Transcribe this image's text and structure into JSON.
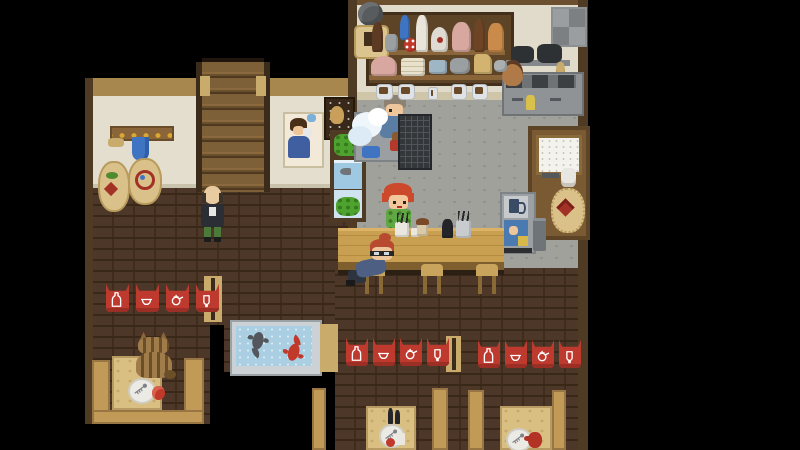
{
  "window": {
    "width": 800,
    "height": 450,
    "background": "#000000"
  },
  "scene": {
    "description": "top-down pixel-art izakaya tavern interior",
    "areas": [
      "kitchen-and-bar",
      "entry-hall-with-stairs",
      "booth-seating",
      "koi-pond-nook"
    ]
  },
  "palette": {
    "wall_cream": "#e3decd",
    "wood_beam": "#a8874e",
    "wood_frame": "#4f3b24",
    "brick_floor": "#4c3729",
    "kitchen_floor": "#a1a19b",
    "counter_top": "#c99f52",
    "bench_tan": "#c29a58",
    "table_tan": "#d9bf82",
    "banner_red": "#bf3a2e",
    "pond_water": "#aacfe2",
    "koi_red": "#c0392a",
    "koi_grey": "#53565c",
    "stairs_wood": "#7d5f38"
  },
  "characters": [
    {
      "id": "dishwasher",
      "desc": "man washing dishes at kitchen sink",
      "hair": "#8d8271",
      "shirt": "#5c7da3"
    },
    {
      "id": "bartender",
      "desc": "red-haired woman behind bar counter",
      "hair": "#cc4a2b",
      "shirt": "#61a844"
    },
    {
      "id": "bald-patron",
      "desc": "bald man in dark jacket near stairs",
      "jacket": "#2b2e34",
      "pants": "#4c7a38"
    },
    {
      "id": "seated-patron",
      "desc": "red-haired customer with glasses on bar stool",
      "hair": "#b84a2f",
      "shirt": "#4d5f83"
    },
    {
      "id": "cat",
      "desc": "tabby cat seated at left booth table",
      "fur": "#a07c4a"
    }
  ],
  "banners": {
    "color": "#bf3a2e",
    "icon_names": [
      "sake-bottle",
      "bowl",
      "teapot",
      "sake-cup"
    ],
    "rows": [
      {
        "id": "left",
        "x": 106,
        "y": 284,
        "gap": 30,
        "w": 23,
        "h": 28
      },
      {
        "id": "middle",
        "x": 346,
        "y": 338,
        "gap": 27,
        "w": 22,
        "h": 28
      },
      {
        "id": "right",
        "x": 478,
        "y": 340,
        "gap": 27,
        "w": 22,
        "h": 28
      }
    ]
  },
  "decor": {
    "shelf_bottles": [
      {
        "name": "dark-sake-bottle",
        "x": 372,
        "y": 22,
        "w": 11,
        "h": 30,
        "c": "#5d3a22",
        "r": "45% 45% 15% 15%"
      },
      {
        "name": "grey-jar",
        "x": 385,
        "y": 34,
        "w": 13,
        "h": 18,
        "c": "#9aa0a2",
        "r": "30%"
      },
      {
        "name": "blue-flask",
        "x": 400,
        "y": 15,
        "w": 10,
        "h": 25,
        "c": "#3f74c2",
        "r": "45% 45% 15% 15%"
      },
      {
        "name": "spotted-red-ball",
        "x": 404,
        "y": 38,
        "w": 13,
        "h": 14,
        "c": "#c0392a",
        "r": "50%",
        "dots": "#ffffff"
      },
      {
        "name": "white-bottle",
        "x": 416,
        "y": 15,
        "w": 12,
        "h": 37,
        "c": "#e9e5da",
        "r": "40% 40% 10% 10%"
      },
      {
        "name": "round-flask",
        "x": 431,
        "y": 27,
        "w": 17,
        "h": 25,
        "c": "#dfdbd2",
        "r": "50% 50% 20% 20%",
        "dot": "#a33226"
      },
      {
        "name": "pink-jar",
        "x": 452,
        "y": 22,
        "w": 19,
        "h": 30,
        "c": "#d8a8a0",
        "r": "45% 45% 20% 20%"
      },
      {
        "name": "brown-bottle",
        "x": 474,
        "y": 19,
        "w": 11,
        "h": 33,
        "c": "#6e4426",
        "r": "45% 45% 15% 15%"
      },
      {
        "name": "orange-jar",
        "x": 488,
        "y": 23,
        "w": 16,
        "h": 29,
        "c": "#c98a4a",
        "r": "40% 40% 15% 15%"
      }
    ],
    "shelf_dishes": [
      {
        "name": "pink-lidded-pot",
        "x": 371,
        "y": 56,
        "w": 26,
        "h": 20,
        "c": "#d8a8a0",
        "r": "50% 50% 15% 15%"
      },
      {
        "name": "plate-stack",
        "x": 401,
        "y": 58,
        "w": 24,
        "h": 18,
        "c": "#e8e2cc",
        "r": "15%",
        "lines": "#c9bfa0"
      },
      {
        "name": "blue-bowls",
        "x": 429,
        "y": 60,
        "w": 18,
        "h": 14,
        "c": "#9fb6c4",
        "r": "20%"
      },
      {
        "name": "grey-pot",
        "x": 450,
        "y": 58,
        "w": 20,
        "h": 16,
        "c": "#9aa0a2",
        "r": "35%"
      },
      {
        "name": "paper-bag",
        "x": 474,
        "y": 54,
        "w": 18,
        "h": 20,
        "c": "#d2b370",
        "r": "20% 40% 10% 10%"
      },
      {
        "name": "grey-bowl",
        "x": 494,
        "y": 60,
        "w": 13,
        "h": 12,
        "c": "#aab0b2",
        "r": "40%"
      }
    ],
    "back_counter_jars": [
      {
        "x": 376,
        "y": 84,
        "w": 15,
        "h": 14
      },
      {
        "x": 398,
        "y": 84,
        "w": 15,
        "h": 14
      },
      {
        "x": 428,
        "y": 87,
        "w": 8,
        "h": 11
      },
      {
        "x": 451,
        "y": 84,
        "w": 14,
        "h": 14
      },
      {
        "x": 472,
        "y": 84,
        "w": 14,
        "h": 14
      }
    ],
    "bar_counter_items": [
      {
        "name": "utensil-pot",
        "x": 395,
        "y": 222,
        "w": 14,
        "h": 15,
        "c": "#e9e7e0",
        "r": "15%",
        "sticks": true
      },
      {
        "name": "small-cup",
        "x": 411,
        "y": 228,
        "w": 8,
        "h": 9,
        "c": "#e9e7e0",
        "r": "20%"
      },
      {
        "name": "shaker",
        "x": 417,
        "y": 222,
        "w": 11,
        "h": 14,
        "c": "#d9c9a8",
        "r": "40% 40% 15% 15%",
        "cap": "#7a4a28"
      },
      {
        "name": "black-bottle",
        "x": 442,
        "y": 219,
        "w": 11,
        "h": 19,
        "c": "#232528",
        "r": "40% 40% 10% 10%"
      },
      {
        "name": "chopstick-pot",
        "x": 456,
        "y": 220,
        "w": 15,
        "h": 18,
        "c": "#c9ccce",
        "r": "15%",
        "sticks": true
      }
    ]
  },
  "pond": {
    "x": 230,
    "y": 320,
    "w": 88,
    "h": 52,
    "water": "#aacfe2",
    "frame": "#cbd1d4",
    "koi": [
      {
        "name": "grey-koi",
        "color": "#53565c",
        "x": 10,
        "y": 3,
        "rotation": 12
      },
      {
        "name": "red-koi",
        "color": "#c0392a",
        "x": 48,
        "y": 6,
        "rotation": 198
      }
    ]
  }
}
